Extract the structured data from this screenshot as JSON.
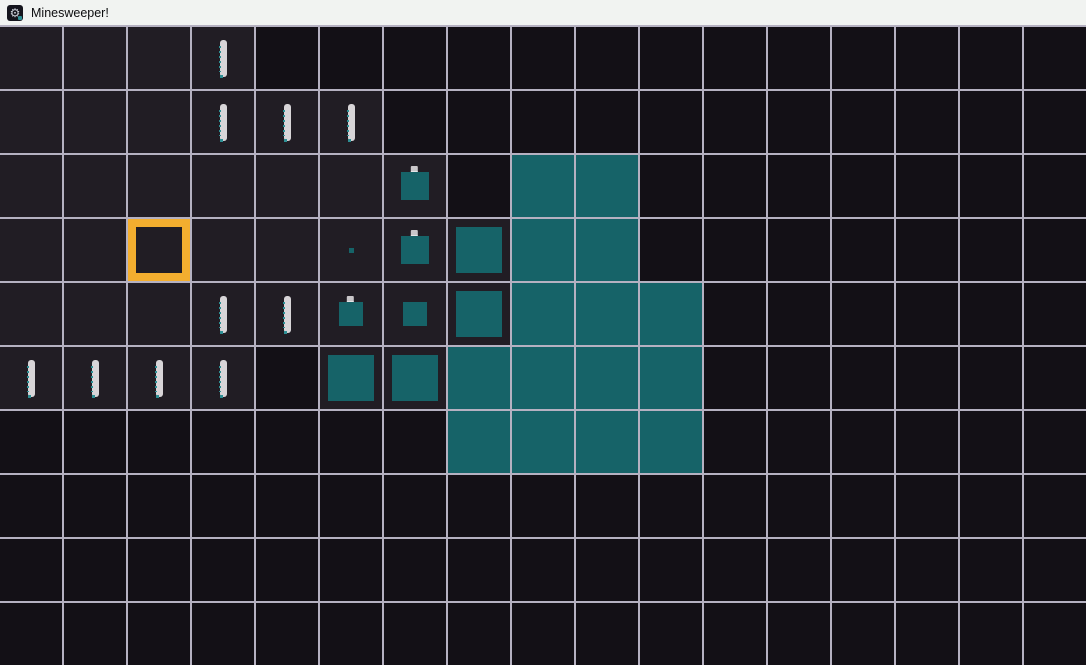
{
  "window": {
    "title": "Minesweeper!",
    "icon": "gear-mine-icon"
  },
  "theme": {
    "titlebar_bg": "#f1f3f1",
    "titlebar_text": "#0c0c0e",
    "gridline": "#b5b1c1",
    "cell_unrevealed": "#131016",
    "cell_revealed": "#211d24",
    "teal_fill": "#166368",
    "cursor_orange": "#f3ae2f",
    "number_glyph": "#d8d5d8"
  },
  "board": {
    "cols": 17,
    "rows": 10,
    "cell_size_px": 64,
    "legend": {
      ".": "unrevealed",
      "e": "revealed-empty",
      "1": "revealed-one",
      "d": "reveal-dot",
      "a": "reveal-square-24",
      "A": "reveal-square-24-nub",
      "B": "reveal-square-28-nub",
      "L": "reveal-square-46",
      "F": "teal-full",
      "C": "cursor-cell"
    },
    "cells": [
      "eee1.............",
      "eee111...........",
      "eeeeeeB.FF.......",
      "eeCeedBLFF.......",
      "eee11AaLFFF......",
      "1111.LLFFFF......",
      ".......FFFF......",
      ".................",
      ".................",
      "................."
    ],
    "cursor": {
      "row": 3,
      "col": 2
    }
  }
}
